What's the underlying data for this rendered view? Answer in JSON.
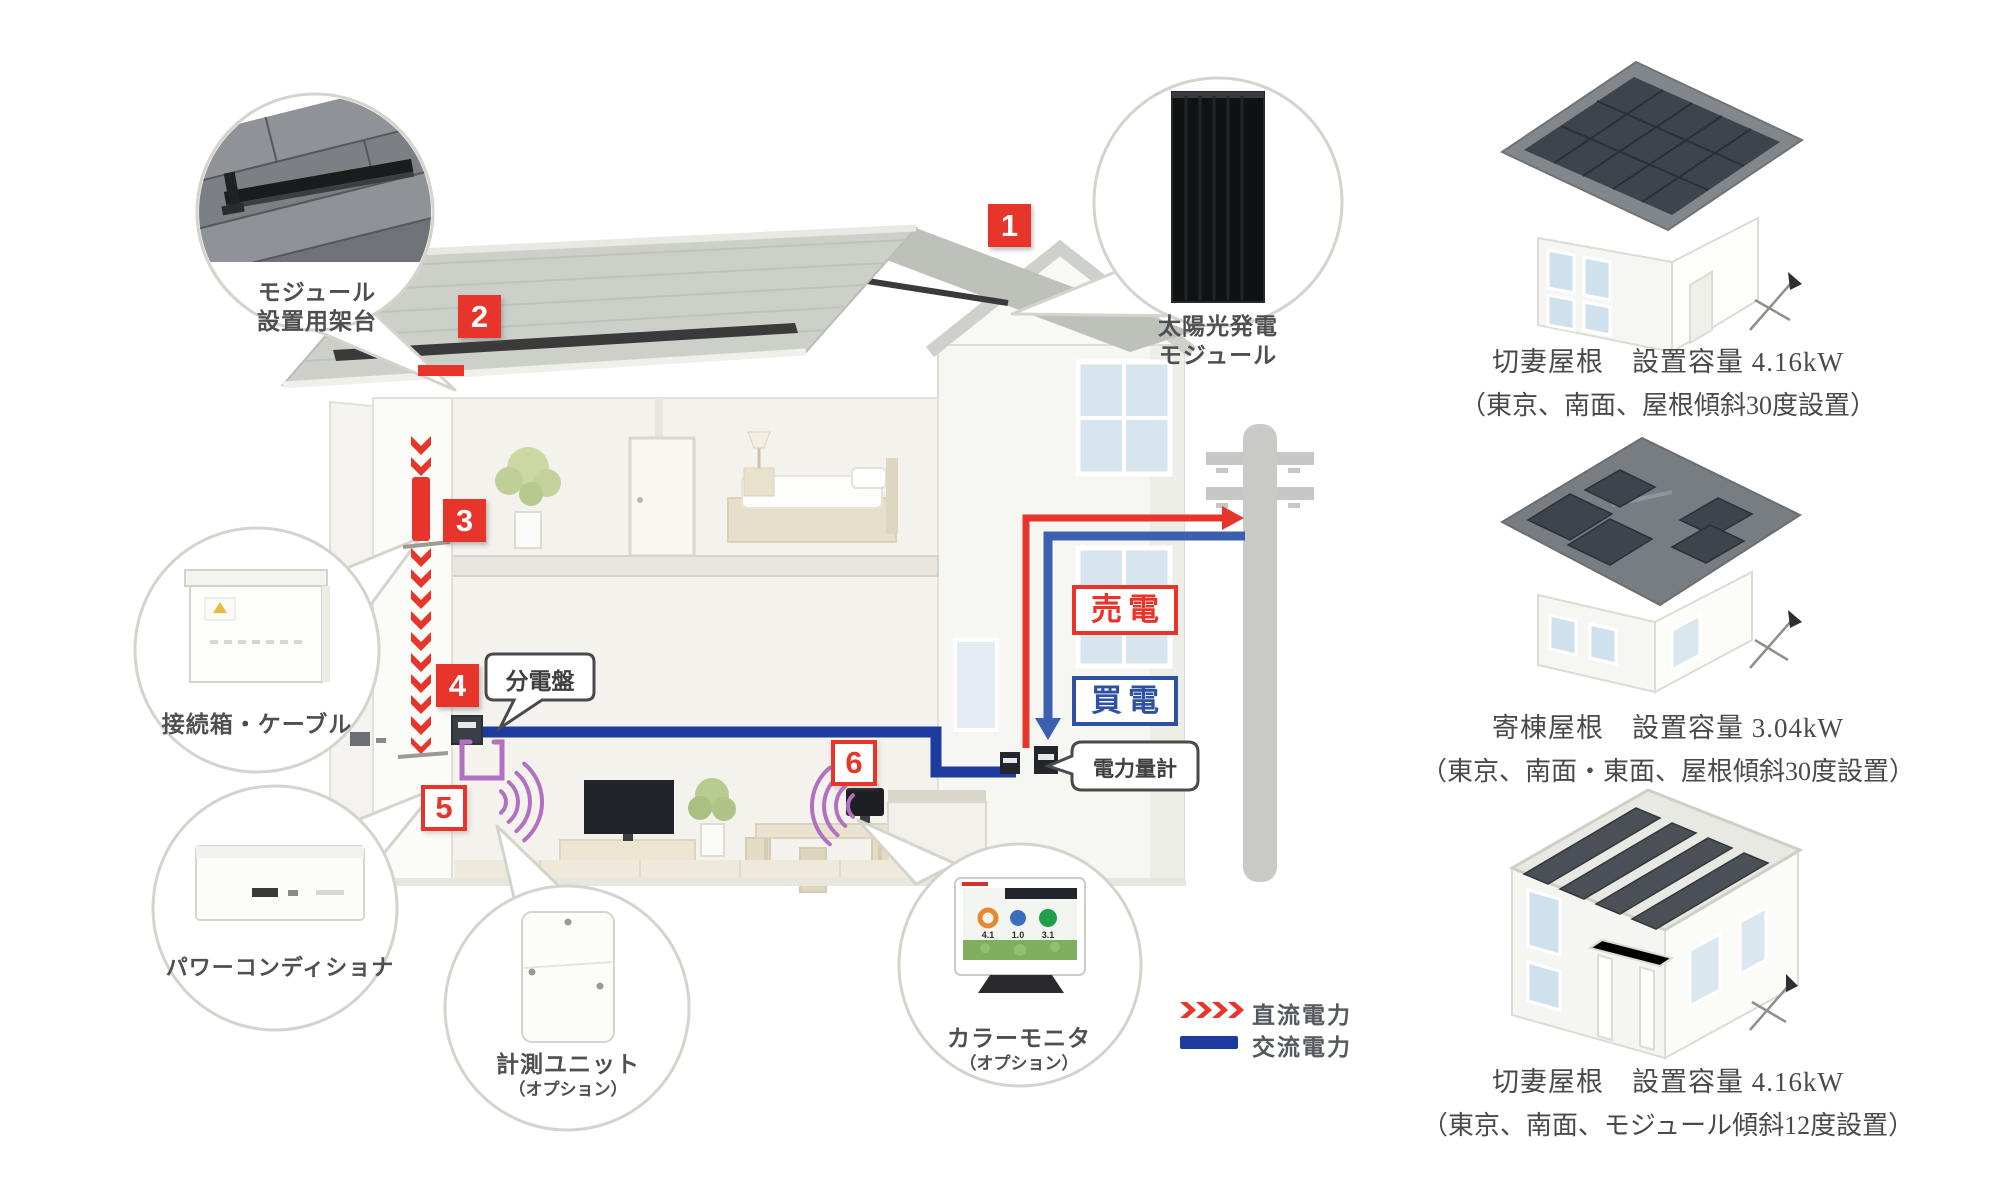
{
  "diagram": {
    "badges": {
      "b1": "1",
      "b2": "2",
      "b3": "3",
      "b4": "4",
      "b5": "5",
      "b6": "6"
    },
    "callouts": {
      "solar_module": {
        "line1": "太陽光発電",
        "line2": "モジュール"
      },
      "mounting_rack": {
        "line1": "モジュール",
        "line2": "設置用架台"
      },
      "junction_box": {
        "label": "接続箱・ケーブル"
      },
      "power_conditioner": {
        "label": "パワーコンディショナ"
      },
      "measurement_unit": {
        "label": "計測ユニット",
        "option": "（オプション）"
      },
      "color_monitor": {
        "label": "カラーモニタ",
        "option": "（オプション）",
        "screen_values": [
          "4.1",
          "1.0",
          "3.1"
        ]
      }
    },
    "bubbles": {
      "distribution_board": "分電盤",
      "power_meter": "電力量計"
    },
    "flows": {
      "sell": "売電",
      "buy": "買電"
    },
    "legend": {
      "dc_label": "直流電力",
      "ac_label": "交流電力"
    },
    "colors": {
      "badge_red": "#e8352b",
      "dc_red": "#e8352b",
      "ac_blue": "#1d3a9e",
      "buy_blue": "#3c60b0",
      "wireless_purple": "#b36fc0"
    }
  },
  "examples": [
    {
      "title": "切妻屋根　設置容量 4.16kW",
      "condition": "（東京、南面、屋根傾斜30度設置）"
    },
    {
      "title": "寄棟屋根　設置容量 3.04kW",
      "condition": "（東京、南面・東面、屋根傾斜30度設置）"
    },
    {
      "title": "切妻屋根　設置容量 4.16kW",
      "condition": "（東京、南面、モジュール傾斜12度設置）"
    }
  ]
}
